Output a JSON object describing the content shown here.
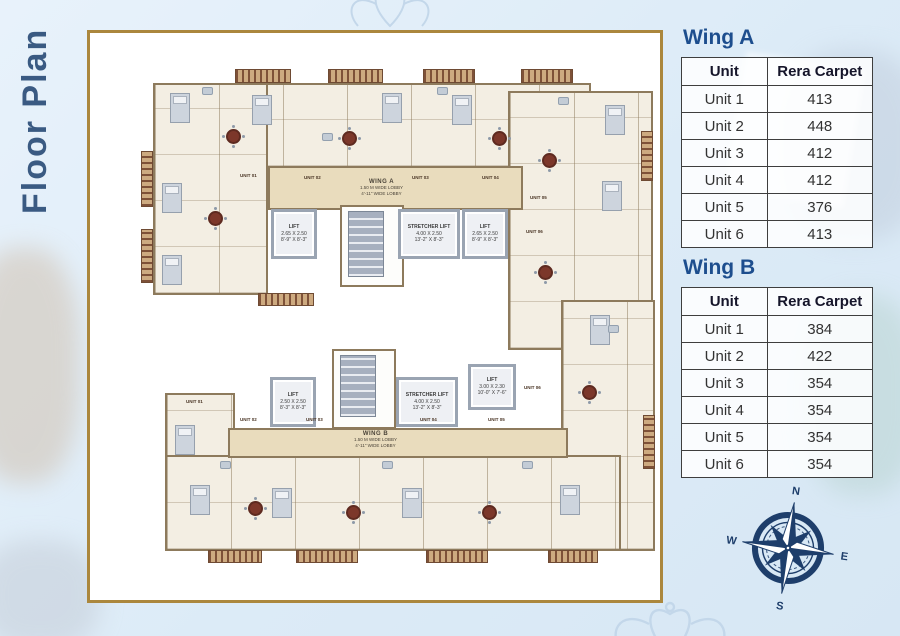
{
  "page_title": "Floor Plan",
  "colors": {
    "frame_gold": "#ab873d",
    "heading_navy": "#1d4e8e",
    "title_blue": "#3a5a82",
    "compass_navy": "#1e3e6b",
    "background": "#dcebf7"
  },
  "tables": {
    "wing_a": {
      "heading": "Wing A",
      "columns": [
        "Unit",
        "Rera Carpet"
      ],
      "rows": [
        {
          "unit": "Unit 1",
          "carpet": "413"
        },
        {
          "unit": "Unit 2",
          "carpet": "448"
        },
        {
          "unit": "Unit 3",
          "carpet": "412"
        },
        {
          "unit": "Unit 4",
          "carpet": "412"
        },
        {
          "unit": "Unit 5",
          "carpet": "376"
        },
        {
          "unit": "Unit 6",
          "carpet": "413"
        }
      ]
    },
    "wing_b": {
      "heading": "Wing B",
      "columns": [
        "Unit",
        "Rera Carpet"
      ],
      "rows": [
        {
          "unit": "Unit 1",
          "carpet": "384"
        },
        {
          "unit": "Unit 2",
          "carpet": "422"
        },
        {
          "unit": "Unit 3",
          "carpet": "354"
        },
        {
          "unit": "Unit 4",
          "carpet": "354"
        },
        {
          "unit": "Unit 5",
          "carpet": "354"
        },
        {
          "unit": "Unit 6",
          "carpet": "354"
        }
      ]
    }
  },
  "plan": {
    "wing_a": {
      "label": "WING A",
      "lobby_m": "1.50 M WIDE LOBBY",
      "lobby_ft": "4'-11\" WIDE LOBBY"
    },
    "wing_b": {
      "label": "WING B",
      "lobby_m": "1.50 M WIDE LOBBY",
      "lobby_ft": "4'-11\" WIDE LOBBY"
    },
    "lifts": {
      "a_left": {
        "title": "LIFT",
        "m": "2.65 X 2.50",
        "ft": "8'-9\" X 8'-3\""
      },
      "a_stretcher": {
        "title": "STRETCHER LIFT",
        "m": "4.00 X 2.50",
        "ft": "13'-2\" X 8'-3\""
      },
      "a_right": {
        "title": "LIFT",
        "m": "2.65 X 2.50",
        "ft": "8'-9\" X 8'-3\""
      },
      "b_left": {
        "title": "LIFT",
        "m": "2.50 X 2.50",
        "ft": "8'-3\" X 8'-3\""
      },
      "b_stretcher": {
        "title": "STRETCHER LIFT",
        "m": "4.00 X 2.50",
        "ft": "13'-2\" X 8'-3\""
      },
      "b_right": {
        "title": "LIFT",
        "m": "3.00 X 2.30",
        "ft": "10'-0\" X 7'-6\""
      }
    },
    "units_a": [
      "UNIT 01",
      "UNIT 02",
      "UNIT 03",
      "UNIT 04",
      "UNIT 05",
      "UNIT 06"
    ],
    "units_b": [
      "UNIT 01",
      "UNIT 02",
      "UNIT 03",
      "UNIT 04",
      "UNIT 05",
      "UNIT 06"
    ]
  },
  "compass": {
    "n": "N",
    "e": "E",
    "s": "S",
    "w": "W"
  }
}
